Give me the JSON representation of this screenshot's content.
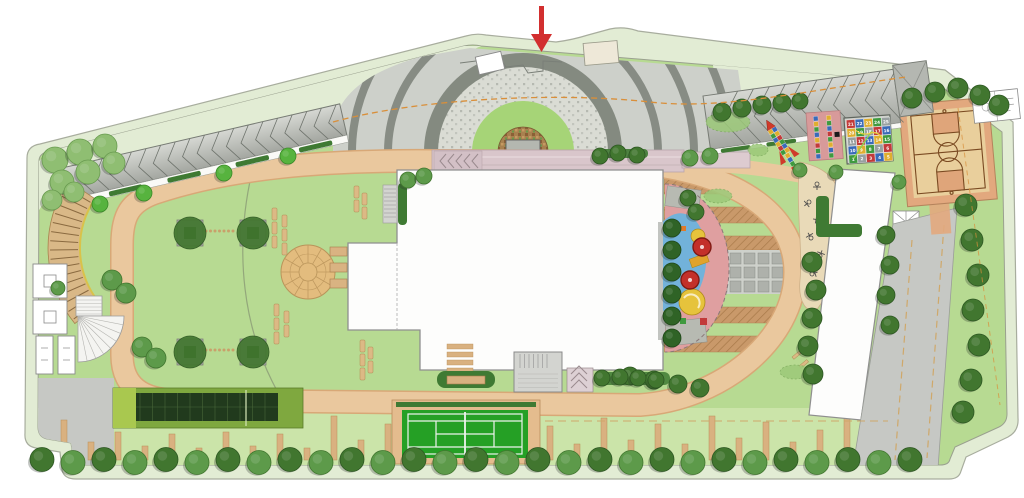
{
  "figure": {
    "type": "landscape-site-plan",
    "width": 1024,
    "height": 498
  },
  "palette": {
    "page": "#ffffff",
    "band": "#e2ecd4",
    "band_edge": "#a8ad9e",
    "lawn": "#b7da92",
    "lawn_light": "#cbe4a9",
    "path": "#eac89e",
    "path_edge": "#d8a877",
    "plaza": "#cdd0ca",
    "plaza_arc": "#878c84",
    "ring_dark": "#848a80",
    "stone": "#dadcd4",
    "ring_green": "#a6d477",
    "mosaic": "#a8814f",
    "canopy_light": "#d6d8d3",
    "canopy_dark": "#a3a6a0",
    "rib": "#6f746d",
    "pergola": "#d9b887",
    "pergola_slat": "#8a6a40",
    "building": "#fdfdfc",
    "building_edge": "#8f8f8f",
    "terrace": "#d9c6cb",
    "hedge": "#3f7a33",
    "play_pink": "#df9fa0",
    "play_blue": "#72b2da",
    "play_yellow": "#e6c33c",
    "play_red": "#c3302a",
    "orchard": "#c9996a",
    "paver_bg": "#ced1cb",
    "paver_tile": "#aeb1ab",
    "court_border": "#e2a87e",
    "court_wood": "#e9cf9c",
    "court_key": "#dfa57a",
    "court_line": "#7a4a22",
    "tennis": "#25a025",
    "tennis_line": "#eef2ee",
    "tennis_border": "#e4bc8e",
    "trellis_frame": "#7fa83f",
    "trellis_dark": "#213a1d",
    "road": "#c6c8c4",
    "stripe": "#d9b180",
    "arrow": "#d22f2f",
    "axis_dash": "#d98f3a",
    "tan_dash": "#cfa86a"
  },
  "entrance": {
    "arrow_color": "#d22f2f"
  },
  "game_board": {
    "rows": [
      [
        21,
        22,
        23,
        24,
        25
      ],
      [
        20,
        19,
        18,
        17,
        16
      ],
      [
        11,
        12,
        13,
        14,
        15
      ],
      [
        10,
        9,
        8,
        7,
        6
      ],
      [
        1,
        2,
        3,
        4,
        5
      ]
    ],
    "tile_colors": [
      "#c23a3a",
      "#3a6ab8",
      "#dfae2f",
      "#3f9a3f",
      "#98a0a0"
    ],
    "number_color": "#ffffff",
    "border_color": "#5f655e"
  },
  "hopscotch_mat": {
    "mat_color": "#d89a9a",
    "block_color": "#1a1a1a",
    "columns": [
      [
        "#3a6ab8",
        "#dfae2f",
        "#3f9a3f",
        "#3a6ab8",
        "#dfae2f",
        "#c23a3a",
        "#3f9a3f",
        "#3a6ab8"
      ],
      [
        "#dfae2f",
        "#3f9a3f",
        "#3a6ab8",
        "#c23a3a",
        "#3f9a3f",
        "#dfae2f",
        "#3a6ab8",
        "#3f9a3f"
      ]
    ]
  },
  "rocket_hopscotch": {
    "nose_color": "#d03a2a",
    "fin_color": "#d03a2a",
    "body_rows": [
      [
        "#dfae2f",
        "#3a6ab8"
      ],
      [
        "#3f9a3f",
        "#dfae2f"
      ],
      [
        "#3a6ab8",
        "#c23a3a"
      ],
      [
        "#dfae2f",
        "#3f9a3f"
      ],
      [
        "#c23a3a",
        "#3a6ab8"
      ],
      [
        "#3f9a3f",
        "#dfae2f"
      ]
    ],
    "tail_colors": [
      "#dfae2f",
      "#3a6ab8",
      "#3f9a3f"
    ]
  },
  "vegetation": {
    "tree_shades": {
      "dark": [
        "#41762f",
        "#2d5722"
      ],
      "medium": [
        "#5d9a4a",
        "#41762f"
      ],
      "light": [
        "#8fbe72",
        "#699b50"
      ],
      "hedge": [
        "#2f6326",
        "#1e4517"
      ],
      "bright": [
        "#57b33e",
        "#3a8a28"
      ]
    },
    "bottom_row": {
      "y": 461,
      "x_start": 42,
      "step": 31,
      "count": 29,
      "r": 12
    },
    "clusters": [
      [
        55,
        160,
        13,
        2
      ],
      [
        80,
        152,
        13,
        2
      ],
      [
        105,
        146,
        12,
        2
      ],
      [
        62,
        182,
        12,
        2
      ],
      [
        88,
        172,
        12,
        2
      ],
      [
        114,
        163,
        11,
        2
      ],
      [
        52,
        200,
        10,
        2
      ],
      [
        74,
        192,
        10,
        2
      ],
      [
        100,
        204,
        8,
        4
      ],
      [
        144,
        193,
        8,
        4
      ],
      [
        224,
        173,
        8,
        4
      ],
      [
        288,
        156,
        8,
        4
      ],
      [
        112,
        280,
        10,
        1
      ],
      [
        126,
        293,
        10,
        1
      ],
      [
        142,
        347,
        10,
        1
      ],
      [
        156,
        358,
        10,
        1
      ],
      [
        58,
        288,
        7,
        1
      ],
      [
        408,
        180,
        8,
        1
      ],
      [
        424,
        176,
        8,
        1
      ],
      [
        600,
        156,
        8,
        0
      ],
      [
        618,
        153,
        8,
        0
      ],
      [
        637,
        155,
        8,
        0
      ],
      [
        690,
        158,
        8,
        1
      ],
      [
        710,
        156,
        8,
        1
      ],
      [
        722,
        112,
        9,
        0
      ],
      [
        742,
        108,
        9,
        0
      ],
      [
        762,
        105,
        9,
        0
      ],
      [
        782,
        103,
        9,
        0
      ],
      [
        800,
        101,
        8,
        0
      ],
      [
        912,
        98,
        10,
        0
      ],
      [
        935,
        92,
        10,
        0
      ],
      [
        958,
        88,
        10,
        0
      ],
      [
        980,
        95,
        10,
        0
      ],
      [
        999,
        105,
        10,
        0
      ],
      [
        966,
        205,
        11,
        0
      ],
      [
        972,
        240,
        11,
        0
      ],
      [
        978,
        275,
        11,
        0
      ],
      [
        973,
        310,
        11,
        0
      ],
      [
        979,
        345,
        11,
        0
      ],
      [
        971,
        380,
        11,
        0
      ],
      [
        963,
        412,
        11,
        0
      ],
      [
        812,
        262,
        10,
        0
      ],
      [
        816,
        290,
        10,
        0
      ],
      [
        812,
        318,
        10,
        0
      ],
      [
        808,
        346,
        10,
        0
      ],
      [
        813,
        374,
        10,
        0
      ],
      [
        630,
        376,
        9,
        0
      ],
      [
        654,
        380,
        9,
        0
      ],
      [
        678,
        384,
        9,
        0
      ],
      [
        700,
        388,
        9,
        0
      ],
      [
        602,
        378,
        8,
        0
      ],
      [
        620,
        377,
        8,
        0
      ],
      [
        638,
        378,
        8,
        0
      ],
      [
        656,
        380,
        8,
        0
      ],
      [
        672,
        228,
        9,
        3
      ],
      [
        672,
        250,
        9,
        3
      ],
      [
        672,
        272,
        9,
        3
      ],
      [
        672,
        294,
        9,
        3
      ],
      [
        672,
        316,
        9,
        3
      ],
      [
        672,
        338,
        9,
        3
      ],
      [
        688,
        198,
        8,
        0
      ],
      [
        696,
        212,
        8,
        0
      ],
      [
        899,
        182,
        7,
        1
      ],
      [
        800,
        170,
        7,
        1
      ],
      [
        836,
        172,
        7,
        1
      ],
      [
        886,
        235,
        9,
        0
      ],
      [
        890,
        265,
        9,
        0
      ],
      [
        886,
        295,
        9,
        0
      ],
      [
        890,
        325,
        9,
        0
      ]
    ]
  },
  "parking_stripes": {
    "baseline": 460,
    "x_start": 64,
    "step": 27,
    "width": 6,
    "heights": [
      40,
      18,
      28,
      14,
      26,
      12,
      28,
      14,
      26,
      12,
      44,
      20,
      36,
      0,
      0,
      0,
      0,
      0,
      34,
      16,
      42,
      20,
      36,
      16,
      44,
      22,
      38,
      18,
      30,
      44
    ]
  }
}
